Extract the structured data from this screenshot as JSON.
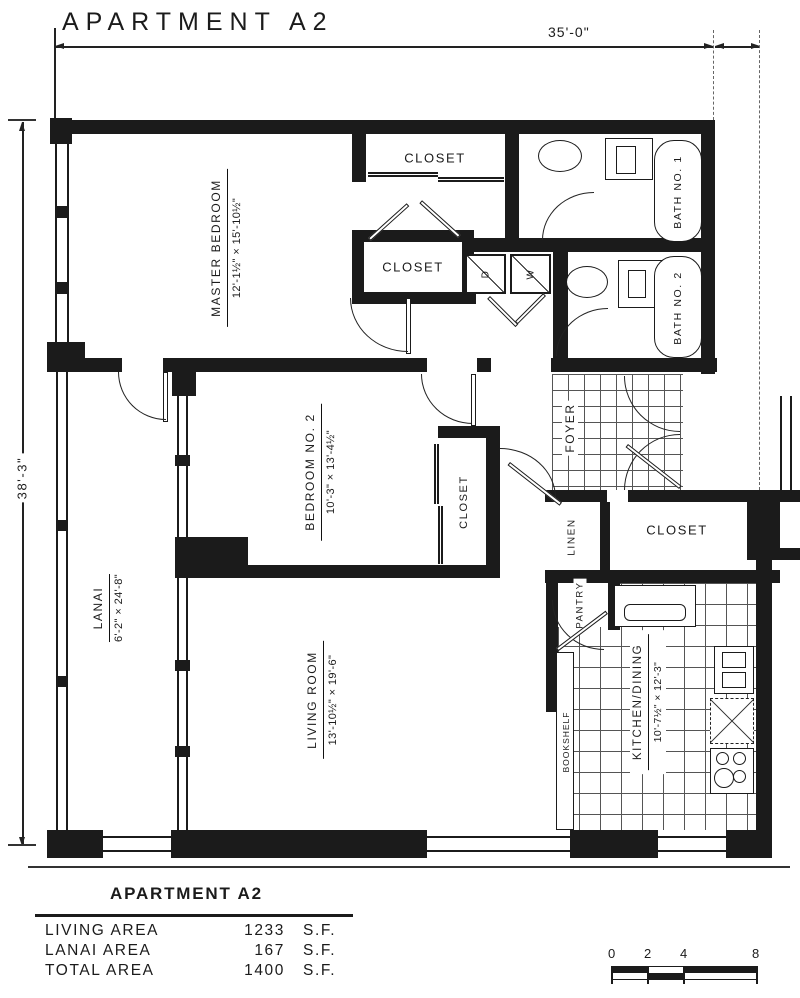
{
  "title": "APARTMENT A2",
  "dimensions": {
    "width_overall": "35'-0\"",
    "height_overall": "38'-3\""
  },
  "rooms": {
    "master_bedroom": {
      "name": "MASTER BEDROOM",
      "size": "12'-1½\" × 15'-10½\""
    },
    "bedroom_2": {
      "name": "BEDROOM NO. 2",
      "size": "10'-3\" × 13'-4½\""
    },
    "living_room": {
      "name": "LIVING ROOM",
      "size": "13'-10½\" × 19'-6\""
    },
    "lanai": {
      "name": "LANAI",
      "size": "6'-2\" × 24'-8\""
    },
    "kitchen_dining": {
      "name": "KITCHEN/DINING",
      "size": "10'-7½\" × 12'-3\""
    },
    "bath_1": {
      "name": "BATH NO. 1"
    },
    "bath_2": {
      "name": "BATH NO. 2"
    },
    "foyer": {
      "name": "FOYER"
    },
    "linen": {
      "name": "LINEN"
    },
    "pantry": {
      "name": "PANTRY"
    },
    "bookshelf": {
      "name": "BOOKSHELF"
    }
  },
  "closets": {
    "master_top": "CLOSET",
    "master_mid": "CLOSET",
    "bedroom_2": "CLOSET",
    "hall": "CLOSET"
  },
  "appliances": {
    "dryer": "D",
    "washer": "W"
  },
  "area_table": {
    "title": "APARTMENT A2",
    "rows": [
      {
        "label": "LIVING AREA",
        "value": "1233",
        "unit": "S.F."
      },
      {
        "label": "LANAI AREA",
        "value": "167",
        "unit": "S.F."
      },
      {
        "label": "TOTAL AREA",
        "value": "1400",
        "unit": "S.F."
      }
    ]
  },
  "scale_bar": {
    "ticks": [
      "0",
      "2",
      "4",
      "8"
    ]
  }
}
